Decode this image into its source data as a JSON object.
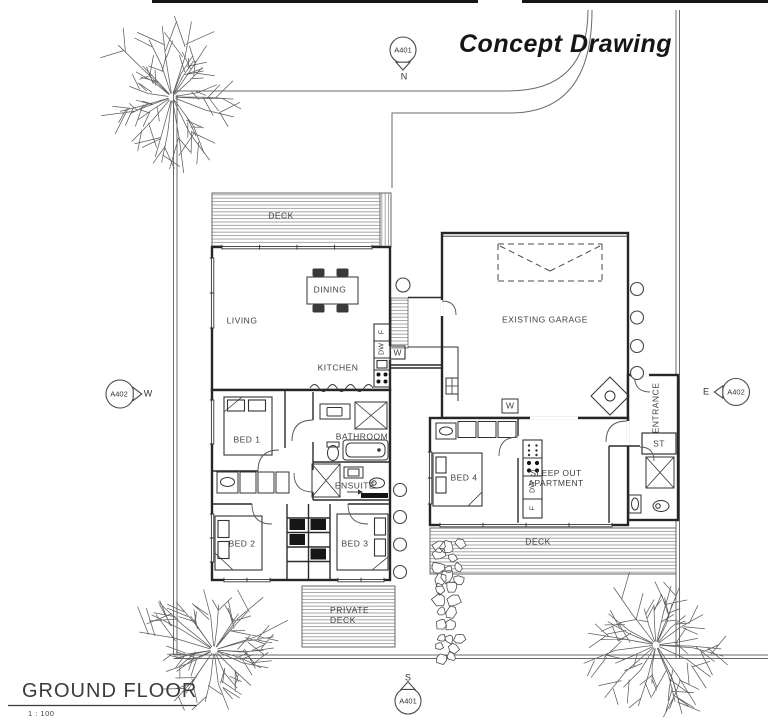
{
  "title": "Concept Drawing",
  "view_markers": {
    "north": {
      "ref": "A401",
      "direction": "N"
    },
    "south": {
      "ref": "A401",
      "direction": "S"
    },
    "west": {
      "ref": "A402",
      "direction": "W"
    },
    "east": {
      "ref": "A402",
      "direction": "E"
    }
  },
  "rooms": {
    "deck_north": "DECK",
    "living": "LIVING",
    "dining": "DINING",
    "kitchen": "KITCHEN",
    "bed1": "BED 1",
    "bathroom": "BATHROOM",
    "ensuite": "ENSUITE",
    "bed2": "BED 2",
    "bed3": "BED 3",
    "private_deck_line1": "PRIVATE",
    "private_deck_line2": "DECK",
    "existing_garage": "EXISTING GARAGE",
    "sleep_out_line1": "SLEEP OUT",
    "sleep_out_line2": "APARTMENT",
    "bed4": "BED 4",
    "entrance": "ENTRANCE",
    "storage": "ST",
    "deck_south": "DECK"
  },
  "appliances": {
    "kitchen_fridge": "F",
    "kitchen_dishwasher": "DW",
    "laundry_washer": "W",
    "garage_washer": "W",
    "sleepout_dishwasher": "DW",
    "sleepout_fridge": "F"
  },
  "footer": {
    "view_name": "GROUND FLOOR",
    "scale": "1 : 100"
  },
  "colors": {
    "ink": "#2b2b2b",
    "hatch": "#8f8f8f",
    "label_text": "#3f3f3f"
  }
}
